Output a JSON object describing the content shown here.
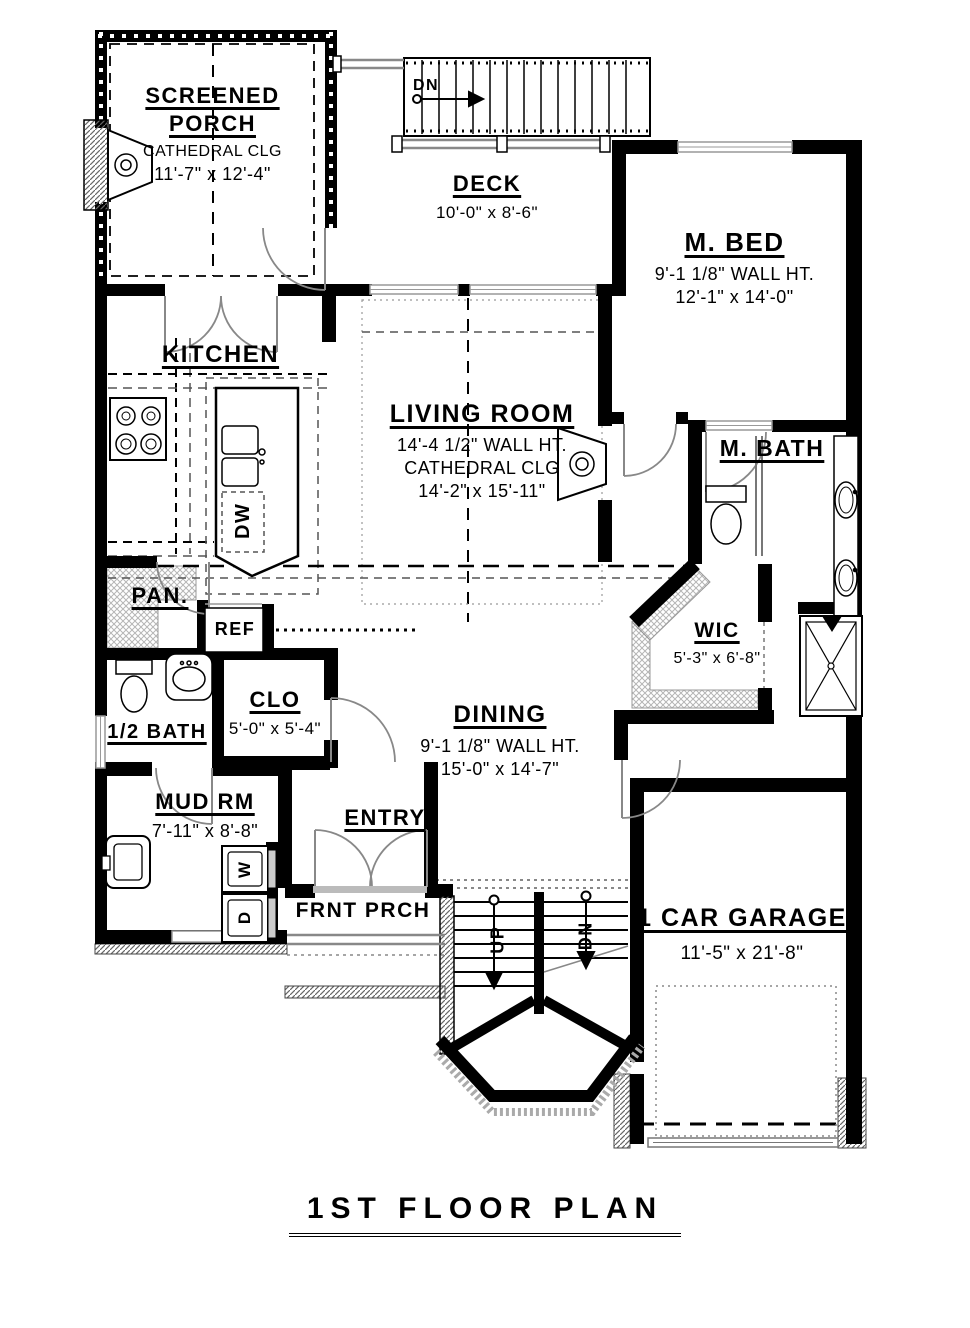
{
  "title": "1ST FLOOR PLAN",
  "rooms": {
    "screened_porch": {
      "name": "SCREENED PORCH",
      "ceiling": "CATHEDRAL CLG",
      "dims": "11'-7\" x 12'-4\""
    },
    "deck": {
      "name": "DECK",
      "dims": "10'-0\" x 8'-6\""
    },
    "m_bed": {
      "name": "M. BED",
      "wall_ht": "9'-1 1/8\" WALL HT.",
      "dims": "12'-1\" x 14'-0\""
    },
    "kitchen": {
      "name": "KITCHEN"
    },
    "living_room": {
      "name": "LIVING ROOM",
      "wall_ht": "14'-4 1/2\" WALL HT.",
      "ceiling": "CATHEDRAL CLG",
      "dims": "14'-2\" x 15'-11\""
    },
    "m_bath": {
      "name": "M. BATH"
    },
    "pantry": {
      "name": "PAN."
    },
    "wic": {
      "name": "WIC",
      "dims": "5'-3\" x 6'-8\""
    },
    "closet": {
      "name": "CLO",
      "dims": "5'-0\" x 5'-4\""
    },
    "half_bath": {
      "name": "1/2 BATH"
    },
    "dining": {
      "name": "DINING",
      "wall_ht": "9'-1 1/8\" WALL HT.",
      "dims": "15'-0\" x 14'-7\""
    },
    "mud_room": {
      "name": "MUD RM",
      "dims": "7'-11\" x 8'-8\""
    },
    "entry": {
      "name": "ENTRY"
    },
    "front_porch": {
      "name": "FRNT PRCH"
    },
    "garage": {
      "name": "1 CAR GARAGE",
      "dims": "11'-5\" x 21'-8\""
    }
  },
  "annotations": {
    "ref": "REF",
    "dw": "DW",
    "washer": "W",
    "dryer": "D",
    "stairs_up": "UP",
    "stairs_dn": "DN",
    "deck_dn": "DN"
  },
  "colors": {
    "wall": "#000000",
    "fixture_line": "#555555",
    "window": "#999999",
    "hatch": "#b5b5b5",
    "background": "#ffffff"
  }
}
